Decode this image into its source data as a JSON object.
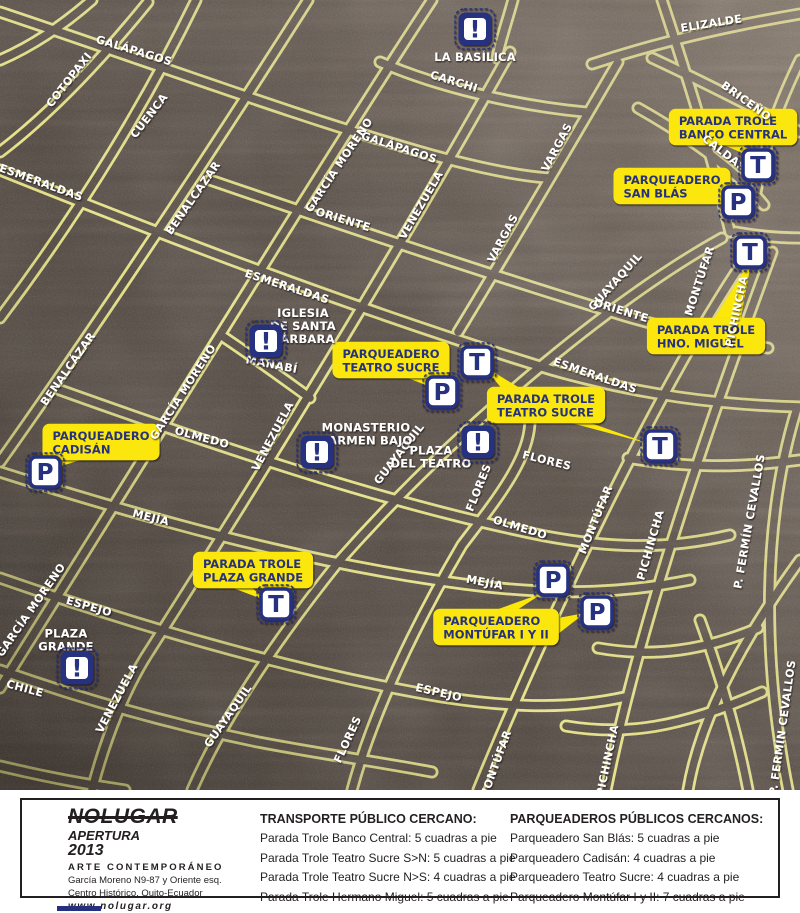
{
  "map": {
    "colors": {
      "street_yellow": "#f3ef83",
      "asphalt": "#4d453e",
      "callout_yellow": "#fbe70a",
      "navy": "#27307f",
      "label_white": "#ffffff",
      "flores_yellow": "#efe77a"
    },
    "street_labels": [
      {
        "t": "ELIZALDE",
        "x": 712,
        "y": 27,
        "r": -9
      },
      {
        "t": "GALÁPAGOS",
        "x": 133,
        "y": 54,
        "r": 17
      },
      {
        "t": "COTOPAXI",
        "x": 72,
        "y": 82,
        "r": -52
      },
      {
        "t": "CUENCA",
        "x": 152,
        "y": 118,
        "r": -52
      },
      {
        "t": "BENALCÁZAR",
        "x": 196,
        "y": 200,
        "r": -55
      },
      {
        "t": "ESMERALDAS",
        "x": 40,
        "y": 186,
        "r": 20
      },
      {
        "t": "GARCÍA MORENO",
        "x": 342,
        "y": 167,
        "r": -56
      },
      {
        "t": "GALÁPAGOS",
        "x": 398,
        "y": 151,
        "r": 18
      },
      {
        "t": "CARCHI",
        "x": 453,
        "y": 85,
        "r": 17
      },
      {
        "t": "VENEZUELA",
        "x": 424,
        "y": 207,
        "r": -60
      },
      {
        "t": "ORIENTE",
        "x": 342,
        "y": 223,
        "r": 17
      },
      {
        "t": "VARGAS",
        "x": 560,
        "y": 149,
        "r": -62
      },
      {
        "t": "BRICEÑO",
        "x": 744,
        "y": 104,
        "r": 36
      },
      {
        "t": "CALDAS",
        "x": 722,
        "y": 156,
        "r": 38
      },
      {
        "t": "VARGAS",
        "x": 506,
        "y": 240,
        "r": -62
      },
      {
        "t": "GUAYAQUIL",
        "x": 618,
        "y": 284,
        "r": -48
      },
      {
        "t": "MONTÚFAR",
        "x": 703,
        "y": 282,
        "r": -72
      },
      {
        "t": "PICHINCHA",
        "x": 740,
        "y": 312,
        "r": -78
      },
      {
        "t": "ORIENTE",
        "x": 620,
        "y": 314,
        "r": 17
      },
      {
        "t": "ESMERALDAS",
        "x": 286,
        "y": 290,
        "r": 18
      },
      {
        "t": "MANABÍ",
        "x": 271,
        "y": 368,
        "r": 11
      },
      {
        "t": "ESMERALDAS",
        "x": 594,
        "y": 379,
        "r": 19
      },
      {
        "t": "BENALCÁZAR",
        "x": 71,
        "y": 371,
        "r": -55
      },
      {
        "t": "GARCÍA MORENO",
        "x": 186,
        "y": 394,
        "r": -57
      },
      {
        "t": "VENEZUELA",
        "x": 276,
        "y": 438,
        "r": -62
      },
      {
        "t": "GUAYAQUIL",
        "x": 402,
        "y": 456,
        "r": -52
      },
      {
        "t": "FLORES",
        "x": 546,
        "y": 464,
        "r": 14
      },
      {
        "t": "FLORES",
        "x": 482,
        "y": 489,
        "r": -68,
        "c": "#efe77a"
      },
      {
        "t": "OLMEDO",
        "x": 201,
        "y": 441,
        "r": 15
      },
      {
        "t": "OLMEDO",
        "x": 519,
        "y": 531,
        "r": 17
      },
      {
        "t": "MONTÚFAR",
        "x": 599,
        "y": 521,
        "r": -68
      },
      {
        "t": "PICHINCHA",
        "x": 654,
        "y": 546,
        "r": -74
      },
      {
        "t": "P. FERMÍN CEVALLOS",
        "x": 753,
        "y": 522,
        "r": -80,
        "s": 10
      },
      {
        "t": "MEJÍA",
        "x": 150,
        "y": 521,
        "r": 14
      },
      {
        "t": "MEJÍA",
        "x": 484,
        "y": 586,
        "r": 11
      },
      {
        "t": "GARCÍA MORENO",
        "x": 34,
        "y": 612,
        "r": -55
      },
      {
        "t": "ESPEJO",
        "x": 88,
        "y": 610,
        "r": 16
      },
      {
        "t": "ESPEJO",
        "x": 438,
        "y": 696,
        "r": 13
      },
      {
        "t": "CHILE",
        "x": 24,
        "y": 692,
        "r": 15
      },
      {
        "t": "VENEZUELA",
        "x": 120,
        "y": 700,
        "r": -62
      },
      {
        "t": "GUAYAQUIL",
        "x": 231,
        "y": 718,
        "r": -55
      },
      {
        "t": "FLORES",
        "x": 351,
        "y": 741,
        "r": -65
      },
      {
        "t": "MONTÚFAR",
        "x": 499,
        "y": 766,
        "r": -70
      },
      {
        "t": "PICHINCHA",
        "x": 611,
        "y": 761,
        "r": -78
      },
      {
        "t": "P. FERMÍN CEVALLOS",
        "x": 786,
        "y": 728,
        "r": -82,
        "s": 10
      }
    ],
    "pois": [
      {
        "id": "la-basilica",
        "glyph": "!",
        "icon": {
          "x": 475,
          "y": 29
        },
        "label": {
          "x": 475,
          "y": 57,
          "lines": [
            "LA BASÍLICA"
          ]
        }
      },
      {
        "id": "iglesia-santa-barbara",
        "glyph": "!",
        "icon": {
          "x": 266,
          "y": 341
        },
        "label": {
          "x": 303,
          "y": 326,
          "lines": [
            "IGLESIA",
            "DE SANTA",
            "BÁRBARA"
          ]
        }
      },
      {
        "id": "monasterio-carmen-bajo",
        "glyph": "!",
        "icon": {
          "x": 317,
          "y": 452
        },
        "label": {
          "x": 366,
          "y": 434,
          "lines": [
            "MONASTERIO",
            "CARMEN BAJO"
          ]
        }
      },
      {
        "id": "plaza-del-teatro",
        "glyph": "!",
        "icon": {
          "x": 478,
          "y": 442
        },
        "label": {
          "x": 431,
          "y": 457,
          "align": "left",
          "lines": [
            "PLAZA",
            "DEL TEATRO"
          ]
        }
      },
      {
        "id": "plaza-grande",
        "glyph": "!",
        "icon": {
          "x": 77,
          "y": 668
        },
        "label": {
          "x": 66,
          "y": 640,
          "lines": [
            "PLAZA",
            "GRANDE"
          ]
        }
      }
    ],
    "stops": [
      {
        "t": "T",
        "x": 758,
        "y": 165
      },
      {
        "t": "T",
        "x": 750,
        "y": 252
      },
      {
        "t": "T",
        "x": 477,
        "y": 362
      },
      {
        "t": "T",
        "x": 660,
        "y": 446
      },
      {
        "t": "T",
        "x": 276,
        "y": 604
      },
      {
        "t": "P",
        "x": 738,
        "y": 202
      },
      {
        "t": "P",
        "x": 442,
        "y": 392
      },
      {
        "t": "P",
        "x": 45,
        "y": 472
      },
      {
        "t": "P",
        "x": 553,
        "y": 580
      },
      {
        "t": "P",
        "x": 597,
        "y": 612
      }
    ],
    "callouts": [
      {
        "id": "parada-trole-banco-central",
        "x": 733,
        "y": 127,
        "lines": [
          "PARADA TROLE",
          "BANCO CENTRAL"
        ],
        "tails": [
          "712,140 742,140 754,158"
        ]
      },
      {
        "id": "parqueadero-san-blas",
        "x": 672,
        "y": 186,
        "lines": [
          "PARQUEADERO",
          "SAN BLÁS"
        ],
        "tails": [
          "700,183 700,199 730,204"
        ]
      },
      {
        "id": "parada-trole-hno-miguel",
        "x": 706,
        "y": 336,
        "lines": [
          "PARADA TROLE",
          "HNO. MIGUEL"
        ],
        "tails": [
          "712,322 740,322 752,258"
        ]
      },
      {
        "id": "parqueadero-teatro-sucre",
        "x": 391,
        "y": 360,
        "lines": [
          "PARQUEADERO",
          "TEATRO SUCRE"
        ],
        "tails": [
          "400,375 424,375 441,391"
        ]
      },
      {
        "id": "parada-trole-teatro-sucre",
        "x": 546,
        "y": 405,
        "lines": [
          "PARADA TROLE",
          "TEATRO SUCRE"
        ],
        "tails": [
          "503,390 523,390 482,365",
          "560,420 582,420 650,444"
        ]
      },
      {
        "id": "parqueadero-cadisan",
        "x": 101,
        "y": 442,
        "lines": [
          "PARQUEADERO",
          "CADISÁN"
        ],
        "tails": [
          "66,457 90,457 52,469"
        ]
      },
      {
        "id": "parada-trole-plaza-grande",
        "x": 253,
        "y": 570,
        "lines": [
          "PARADA TROLE",
          "PLAZA GRANDE"
        ],
        "tails": [
          "225,585 249,585 267,601"
        ]
      },
      {
        "id": "parqueadero-montufar",
        "x": 496,
        "y": 627,
        "lines": [
          "PARQUEADERO",
          "MONTÚFAR I Y II"
        ],
        "tails": [
          "490,612 514,612 543,593",
          "558,618 558,634 585,613"
        ]
      }
    ]
  },
  "footer": {
    "brand": {
      "name": "NOLUGAR",
      "apertura": "APERTURA",
      "year": "2013",
      "tagline": "ARTE CONTEMPORÁNEO",
      "address1": "García Moreno N9-87 y Oriente esq.",
      "address2": "Centro Histórico. Quito-Ecuador",
      "website": "www.nolugar.org"
    },
    "transport": {
      "heading": "TRANSPORTE PÚBLICO CERCANO:",
      "items": [
        "Parada Trole Banco Central: 5 cuadras a pie",
        "Parada Trole Teatro Sucre S>N: 5 cuadras a pie",
        "Parada Trole Teatro Sucre N>S: 4 cuadras a pie",
        "Parada Trole Hermano Miguel: 5 cuadras a pie"
      ]
    },
    "parking": {
      "heading": "PARQUEADEROS PÚBLICOS CERCANOS:",
      "items": [
        "Parqueadero San Blás: 5 cuadras a pie",
        "Parqueadero Cadisán: 4 cuadras a pie",
        "Parqueadero Teatro Sucre: 4 cuadras a pie",
        "Parqueadero Montúfar I y II: 7 cuadras a pie"
      ]
    }
  }
}
